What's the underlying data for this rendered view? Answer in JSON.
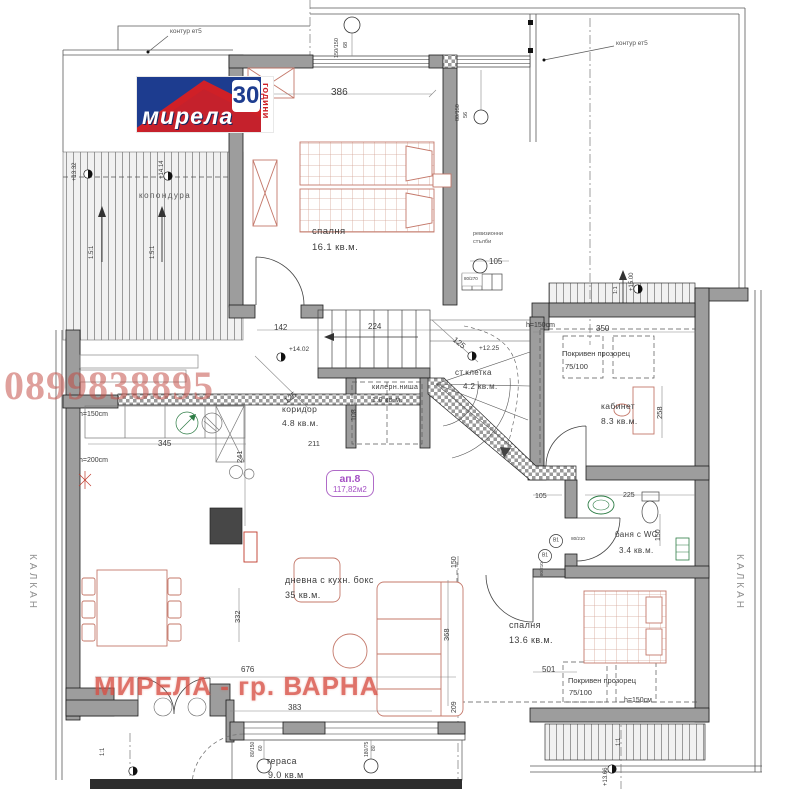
{
  "branding": {
    "logo_text": "мирела",
    "logo_number": "30",
    "logo_years": "години"
  },
  "watermarks": {
    "phone": "0899838895",
    "agency": "МИРЕЛА - гр. ВАРНА"
  },
  "apartment_badge": {
    "id": "ап.8",
    "area": "117,82м2"
  },
  "colors": {
    "logo_blue": "#1d3c8f",
    "logo_red": "#cf2027",
    "watermark_red": "#d84f44",
    "wall_gray": "#9d9d9d",
    "furniture_salmon": "#c4786a",
    "badge_purple": "#a44fc4",
    "fixture_green": "#2e7d46"
  },
  "rooms": [
    {
      "name": "спалня",
      "area": "16.1 кв.м."
    },
    {
      "name": "коридор",
      "area": "4.8 кв.м."
    },
    {
      "name": "килерн.ниша",
      "area": "1.0 кв.м."
    },
    {
      "name": "ст.клетка",
      "area": "4.2 кв.м."
    },
    {
      "name": "кабинет",
      "area": "8.3 кв.м."
    },
    {
      "name": "баня с WC",
      "area": "3.4 кв.м."
    },
    {
      "name": "дневна с кухн. бокс",
      "area": "35 кв.м."
    },
    {
      "name": "спалня",
      "area": "13.6 кв.м."
    },
    {
      "name": "тераса",
      "area": "9.0 кв.м"
    }
  ],
  "labels": [
    {
      "n": "contour-floor5-label-left",
      "t": "контур ет5",
      "x": 170,
      "y": 29,
      "s": 6.5,
      "c": "ann"
    },
    {
      "n": "contour-floor5-label-right",
      "t": "контур ет5",
      "x": 616,
      "y": 41,
      "s": 6.5,
      "c": "ann"
    },
    {
      "n": "dim-386",
      "t": "386",
      "x": 331,
      "y": 88,
      "s": 10
    },
    {
      "n": "window-tag-150-150",
      "t": "150/150",
      "x": 335,
      "y": 58,
      "s": 5.5,
      "r": -90
    },
    {
      "n": "window-tag-68",
      "t": "68",
      "x": 344,
      "y": 48,
      "s": 5.5,
      "r": -90
    },
    {
      "n": "window-tag-80-150-top",
      "t": "80/150",
      "x": 456,
      "y": 121,
      "s": 5.5,
      "r": -90
    },
    {
      "n": "window-tag-56",
      "t": "56",
      "x": 464,
      "y": 118,
      "s": 5.5,
      "r": -90
    },
    {
      "n": "elevation-13-32",
      "t": "+13.32",
      "x": 72,
      "y": 181,
      "s": 6,
      "r": -90
    },
    {
      "n": "elevation-14-14",
      "t": "+14.14",
      "x": 159,
      "y": 179,
      "s": 6,
      "r": -90
    },
    {
      "n": "skylight-area-label",
      "t": "копондура",
      "x": 139,
      "y": 192,
      "s": 8,
      "c": "ann",
      "ls": 1.5
    },
    {
      "n": "slope-1-5-1-left",
      "t": "1.5:1",
      "x": 89,
      "y": 259,
      "s": 6,
      "r": -90
    },
    {
      "n": "slope-1-5-1-right",
      "t": "1.5:1",
      "x": 150,
      "y": 259,
      "s": 6,
      "r": -90
    },
    {
      "n": "room-bedroom1-name",
      "b": "rooms.0.name",
      "x": 312,
      "y": 227,
      "s": 9.5,
      "c": "room"
    },
    {
      "n": "room-bedroom1-area",
      "b": "rooms.0.area",
      "x": 312,
      "y": 243,
      "s": 9.5,
      "c": "room"
    },
    {
      "n": "revision-stairs-label-1",
      "t": "ревизионни",
      "x": 473,
      "y": 232,
      "s": 5.5,
      "c": "ann"
    },
    {
      "n": "revision-stairs-label-2",
      "t": "стълби",
      "x": 473,
      "y": 240,
      "s": 5.5,
      "c": "ann"
    },
    {
      "n": "dim-105-top",
      "t": "105",
      "x": 489,
      "y": 258,
      "s": 8
    },
    {
      "n": "door-tag-80-270",
      "t": "80/270",
      "x": 464,
      "y": 277,
      "s": 4.5
    },
    {
      "n": "dim-142",
      "t": "142",
      "x": 274,
      "y": 324,
      "s": 8
    },
    {
      "n": "dim-224",
      "t": "224",
      "x": 368,
      "y": 323,
      "s": 8
    },
    {
      "n": "dim-125-corridor",
      "t": "125",
      "x": 283,
      "y": 399,
      "s": 8,
      "r": -38
    },
    {
      "n": "dim-125-stair",
      "t": "125",
      "x": 456,
      "y": 336,
      "s": 8,
      "r": 38
    },
    {
      "n": "dim-108",
      "t": "108",
      "x": 351,
      "y": 421,
      "s": 7,
      "r": -90
    },
    {
      "n": "elevation-14-02",
      "t": "+14.02",
      "x": 289,
      "y": 347,
      "s": 6.5
    },
    {
      "n": "elevation-12-25",
      "t": "+12.25",
      "x": 479,
      "y": 346,
      "s": 6.5
    },
    {
      "n": "room-corridor-name",
      "b": "rooms.1.name",
      "x": 282,
      "y": 405,
      "s": 8.5,
      "c": "room"
    },
    {
      "n": "room-corridor-area",
      "b": "rooms.1.area",
      "x": 282,
      "y": 419,
      "s": 8.5,
      "c": "room"
    },
    {
      "n": "room-closet-name",
      "b": "rooms.2.name",
      "x": 372,
      "y": 384,
      "s": 7,
      "c": "room"
    },
    {
      "n": "room-closet-area",
      "b": "rooms.2.area",
      "x": 372,
      "y": 397,
      "s": 7,
      "c": "room"
    },
    {
      "n": "room-staircase-name",
      "b": "rooms.3.name",
      "x": 455,
      "y": 369,
      "s": 8,
      "c": "room"
    },
    {
      "n": "room-staircase-area",
      "b": "rooms.3.area",
      "x": 463,
      "y": 383,
      "s": 8,
      "c": "room"
    },
    {
      "n": "dim-211",
      "t": "211",
      "x": 308,
      "y": 440,
      "s": 7.5
    },
    {
      "n": "elevation-15-00",
      "t": "+15.00",
      "x": 629,
      "y": 291,
      "s": 6,
      "r": -90
    },
    {
      "n": "slope-1-1-top",
      "t": "1:1",
      "x": 614,
      "y": 294,
      "s": 5.5,
      "r": -90
    },
    {
      "n": "height-150-office",
      "t": "h=150cm",
      "x": 526,
      "y": 322,
      "s": 7
    },
    {
      "n": "dim-350",
      "t": "350",
      "x": 596,
      "y": 325,
      "s": 8
    },
    {
      "n": "roof-window-top-label",
      "t": "Покривен прозорец",
      "x": 562,
      "y": 350,
      "s": 7.5
    },
    {
      "n": "roof-window-top-size",
      "t": "75/100",
      "x": 565,
      "y": 363,
      "s": 7.5
    },
    {
      "n": "room-office-name",
      "b": "rooms.4.name",
      "x": 601,
      "y": 402,
      "s": 8.5,
      "c": "room"
    },
    {
      "n": "room-office-area",
      "b": "rooms.4.area",
      "x": 601,
      "y": 417,
      "s": 8.5,
      "c": "room"
    },
    {
      "n": "dim-258",
      "t": "258",
      "x": 656,
      "y": 419,
      "s": 7.5,
      "r": -90
    },
    {
      "n": "dim-105-bath",
      "t": "105",
      "x": 535,
      "y": 493,
      "s": 7
    },
    {
      "n": "dim-225",
      "t": "225",
      "x": 623,
      "y": 492,
      "s": 7
    },
    {
      "n": "dim-150-bath",
      "t": "150",
      "x": 655,
      "y": 541,
      "s": 7,
      "r": -90
    },
    {
      "n": "room-bath-name",
      "b": "rooms.5.name",
      "x": 615,
      "y": 531,
      "s": 8,
      "c": "room"
    },
    {
      "n": "room-bath-area",
      "b": "rooms.5.area",
      "x": 619,
      "y": 547,
      "s": 8,
      "c": "room"
    },
    {
      "n": "door-tag-b1-upper",
      "t": "В1",
      "x": 556,
      "y": 541,
      "s": 5,
      "al": "c"
    },
    {
      "n": "door-tag-b1-lower",
      "t": "В1",
      "x": 545,
      "y": 556,
      "s": 5,
      "al": "c"
    },
    {
      "n": "door-size-80-210-a",
      "t": "80/210",
      "x": 578,
      "y": 539,
      "s": 4.5,
      "al": "c"
    },
    {
      "n": "door-size-80-210-b",
      "t": "80/210",
      "x": 540,
      "y": 576,
      "s": 4.5,
      "r": -90
    },
    {
      "n": "height-150-living",
      "t": "h=150cm",
      "x": 79,
      "y": 411,
      "s": 7
    },
    {
      "n": "height-200-living",
      "t": "h=200cm",
      "x": 79,
      "y": 457,
      "s": 7
    },
    {
      "n": "dim-345",
      "t": "345",
      "x": 158,
      "y": 440,
      "s": 8
    },
    {
      "n": "dim-241",
      "t": "241",
      "x": 236,
      "y": 463,
      "s": 7.5,
      "r": -90
    },
    {
      "n": "room-living-name",
      "b": "rooms.6.name",
      "x": 285,
      "y": 576,
      "s": 9,
      "c": "room"
    },
    {
      "n": "room-living-area",
      "b": "rooms.6.area",
      "x": 285,
      "y": 591,
      "s": 9,
      "c": "room"
    },
    {
      "n": "dim-332",
      "t": "332",
      "x": 234,
      "y": 623,
      "s": 7.5,
      "r": -90
    },
    {
      "n": "dim-676",
      "t": "676",
      "x": 241,
      "y": 666,
      "s": 8
    },
    {
      "n": "dim-383",
      "t": "383",
      "x": 288,
      "y": 704,
      "s": 8
    },
    {
      "n": "room-bedroom2-name",
      "b": "rooms.7.name",
      "x": 509,
      "y": 621,
      "s": 9,
      "c": "room"
    },
    {
      "n": "room-bedroom2-area",
      "b": "rooms.7.area",
      "x": 509,
      "y": 636,
      "s": 9,
      "c": "room"
    },
    {
      "n": "dim-368",
      "t": "368",
      "x": 443,
      "y": 641,
      "s": 7.5,
      "r": -90
    },
    {
      "n": "dim-209",
      "t": "209",
      "x": 451,
      "y": 713,
      "s": 7,
      "r": -90
    },
    {
      "n": "dim-150-mid",
      "t": "150",
      "x": 451,
      "y": 568,
      "s": 7,
      "r": -90
    },
    {
      "n": "dim-501",
      "t": "501",
      "x": 542,
      "y": 666,
      "s": 8
    },
    {
      "n": "roof-window-bottom-label",
      "t": "Покривен прозорец",
      "x": 568,
      "y": 677,
      "s": 7.5
    },
    {
      "n": "roof-window-bottom-size",
      "t": "75/100",
      "x": 569,
      "y": 689,
      "s": 7.5
    },
    {
      "n": "height-150-bedroom2",
      "t": "h=150см",
      "x": 624,
      "y": 697,
      "s": 7
    },
    {
      "n": "room-terrace-name",
      "b": "rooms.8.name",
      "x": 266,
      "y": 757,
      "s": 9,
      "c": "room"
    },
    {
      "n": "room-terrace-area",
      "b": "rooms.8.area",
      "x": 268,
      "y": 771,
      "s": 9,
      "c": "room"
    },
    {
      "n": "window-tag-80-150-bottom",
      "t": "80/150",
      "x": 251,
      "y": 757,
      "s": 5,
      "r": -90
    },
    {
      "n": "window-tag-60",
      "t": "60",
      "x": 259,
      "y": 751,
      "s": 5,
      "r": -90
    },
    {
      "n": "window-tag-180-75",
      "t": "180/75",
      "x": 365,
      "y": 757,
      "s": 5,
      "r": -90
    },
    {
      "n": "window-tag-80",
      "t": "80",
      "x": 372,
      "y": 751,
      "s": 5,
      "r": -90
    },
    {
      "n": "party-wall-left",
      "t": "КАЛКАН",
      "x": 37,
      "y": 554,
      "s": 10,
      "r": 90,
      "c": "side"
    },
    {
      "n": "party-wall-right",
      "t": "КАЛКАН",
      "x": 744,
      "y": 554,
      "s": 10,
      "r": 90,
      "c": "side"
    },
    {
      "n": "slope-1-1-bottom-left",
      "t": "1:1",
      "x": 100,
      "y": 756,
      "s": 6,
      "r": -90
    },
    {
      "n": "slope-1-1-bottom-right",
      "t": "1:1",
      "x": 616,
      "y": 746,
      "s": 6,
      "r": -90
    },
    {
      "n": "elevation-13-66",
      "t": "+13.66",
      "x": 603,
      "y": 786,
      "s": 6,
      "r": -90
    }
  ]
}
